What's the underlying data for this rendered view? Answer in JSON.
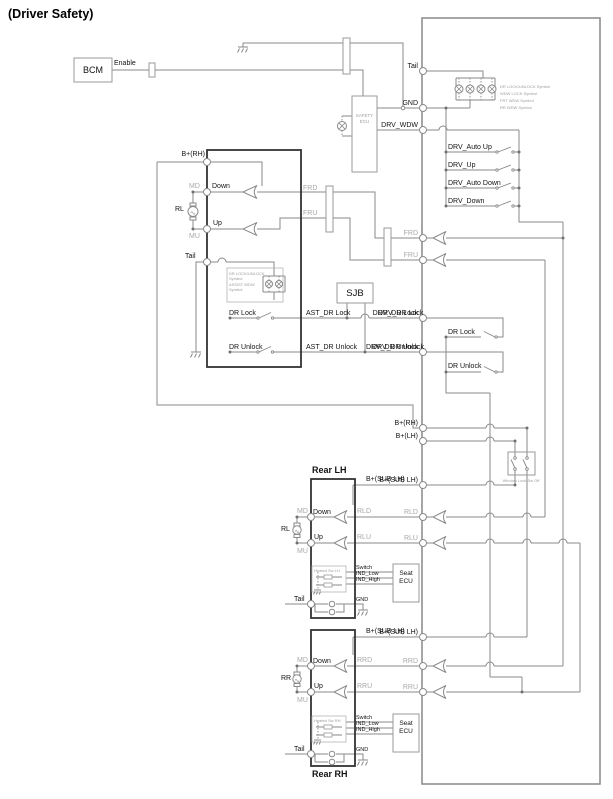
{
  "title": "(Driver Safety)",
  "bcm": {
    "label": "BCM",
    "enable": "Enable"
  },
  "safety_ecu": {
    "line1": "SAFETY",
    "line2": "ECU"
  },
  "sjb": {
    "label": "SJB"
  },
  "bus": {
    "tail": "Tail",
    "gnd": "GND",
    "drv_wdw": "DRV_WDW",
    "frd": "FRD",
    "fru": "FRU",
    "drv_dr_lock": "DRV_DR Lock",
    "drv_dr_unlock": "DRV_DR Unlock",
    "b_rh": "B+(RH)",
    "b_lh": "B+(LH)",
    "b_sub_lh_front": "B+(SUB LH)",
    "b_sub_lh_rear": "B+(SUB LH)",
    "rld": "RLD",
    "rlu": "RLU",
    "rrd": "RRD",
    "rru": "RRU"
  },
  "lamp_annotations": [
    "DR LOCK/UNLOCK Symbol",
    "WDW LOCK Symbol",
    "FRT WDW Symbol",
    "RR WDW Symbol"
  ],
  "drv_switches": {
    "auto_up": "DRV_Auto Up",
    "up": "DRV_Up",
    "auto_down": "DRV_Auto Down",
    "down": "DRV_Down"
  },
  "door_switches": {
    "dr_lock": "DR Lock",
    "dr_unlock": "DR Unlock"
  },
  "window_lock_note": "Window Lock Sw Off",
  "driver_module": {
    "b_rh": "B+(RH)",
    "md": "MD",
    "down": "Down",
    "motor": "RL",
    "up": "Up",
    "mu": "MU",
    "tail": "Tail",
    "frd": "FRD",
    "fru": "FRU",
    "note": [
      "DR LOCK/UNLOCK",
      "Symbol",
      "ASSIST WDW",
      "Symbol"
    ],
    "dr_lock": "DR Lock",
    "dr_unlock": "DR Unlock",
    "ast_dr_lock": "AST_DR Lock",
    "ast_dr_unlock": "AST_DR Unlock",
    "drv_dr_lock": "DRV_DR Lock",
    "drv_dr_unlock": "DRV_DR Unlock"
  },
  "rear_lh": {
    "title": "Rear LH",
    "b_sub": "B+(SUB LH)",
    "md": "MD",
    "down": "Down",
    "motor": "RL",
    "up": "Up",
    "mu": "MU",
    "rld": "RLD",
    "rlu": "RLU",
    "heated_note": "Heated Sw LH",
    "switch": "Switch",
    "ind_low": "IND_Low",
    "ind_high": "IND_High",
    "seat_line1": "Seat",
    "seat_line2": "ECU",
    "tail": "Tail",
    "gnd": "GND"
  },
  "rear_rh": {
    "title": "Rear RH",
    "b_sub": "B+(SUB LH)",
    "md": "MD",
    "down": "Down",
    "motor": "RR",
    "up": "Up",
    "mu": "MU",
    "rrd": "RRD",
    "rru": "RRU",
    "heated_note": "Heated Sw RH",
    "switch": "Switch",
    "ind_low": "IND_Low",
    "ind_high": "IND_High",
    "seat_line1": "Seat",
    "seat_line2": "ECU",
    "tail": "Tail",
    "gnd": "GND"
  },
  "colors": {
    "wire": "#8a8a8a",
    "module_border": "#2b2b2b",
    "label": "#121212",
    "gray_label": "#a8a8a8"
  }
}
